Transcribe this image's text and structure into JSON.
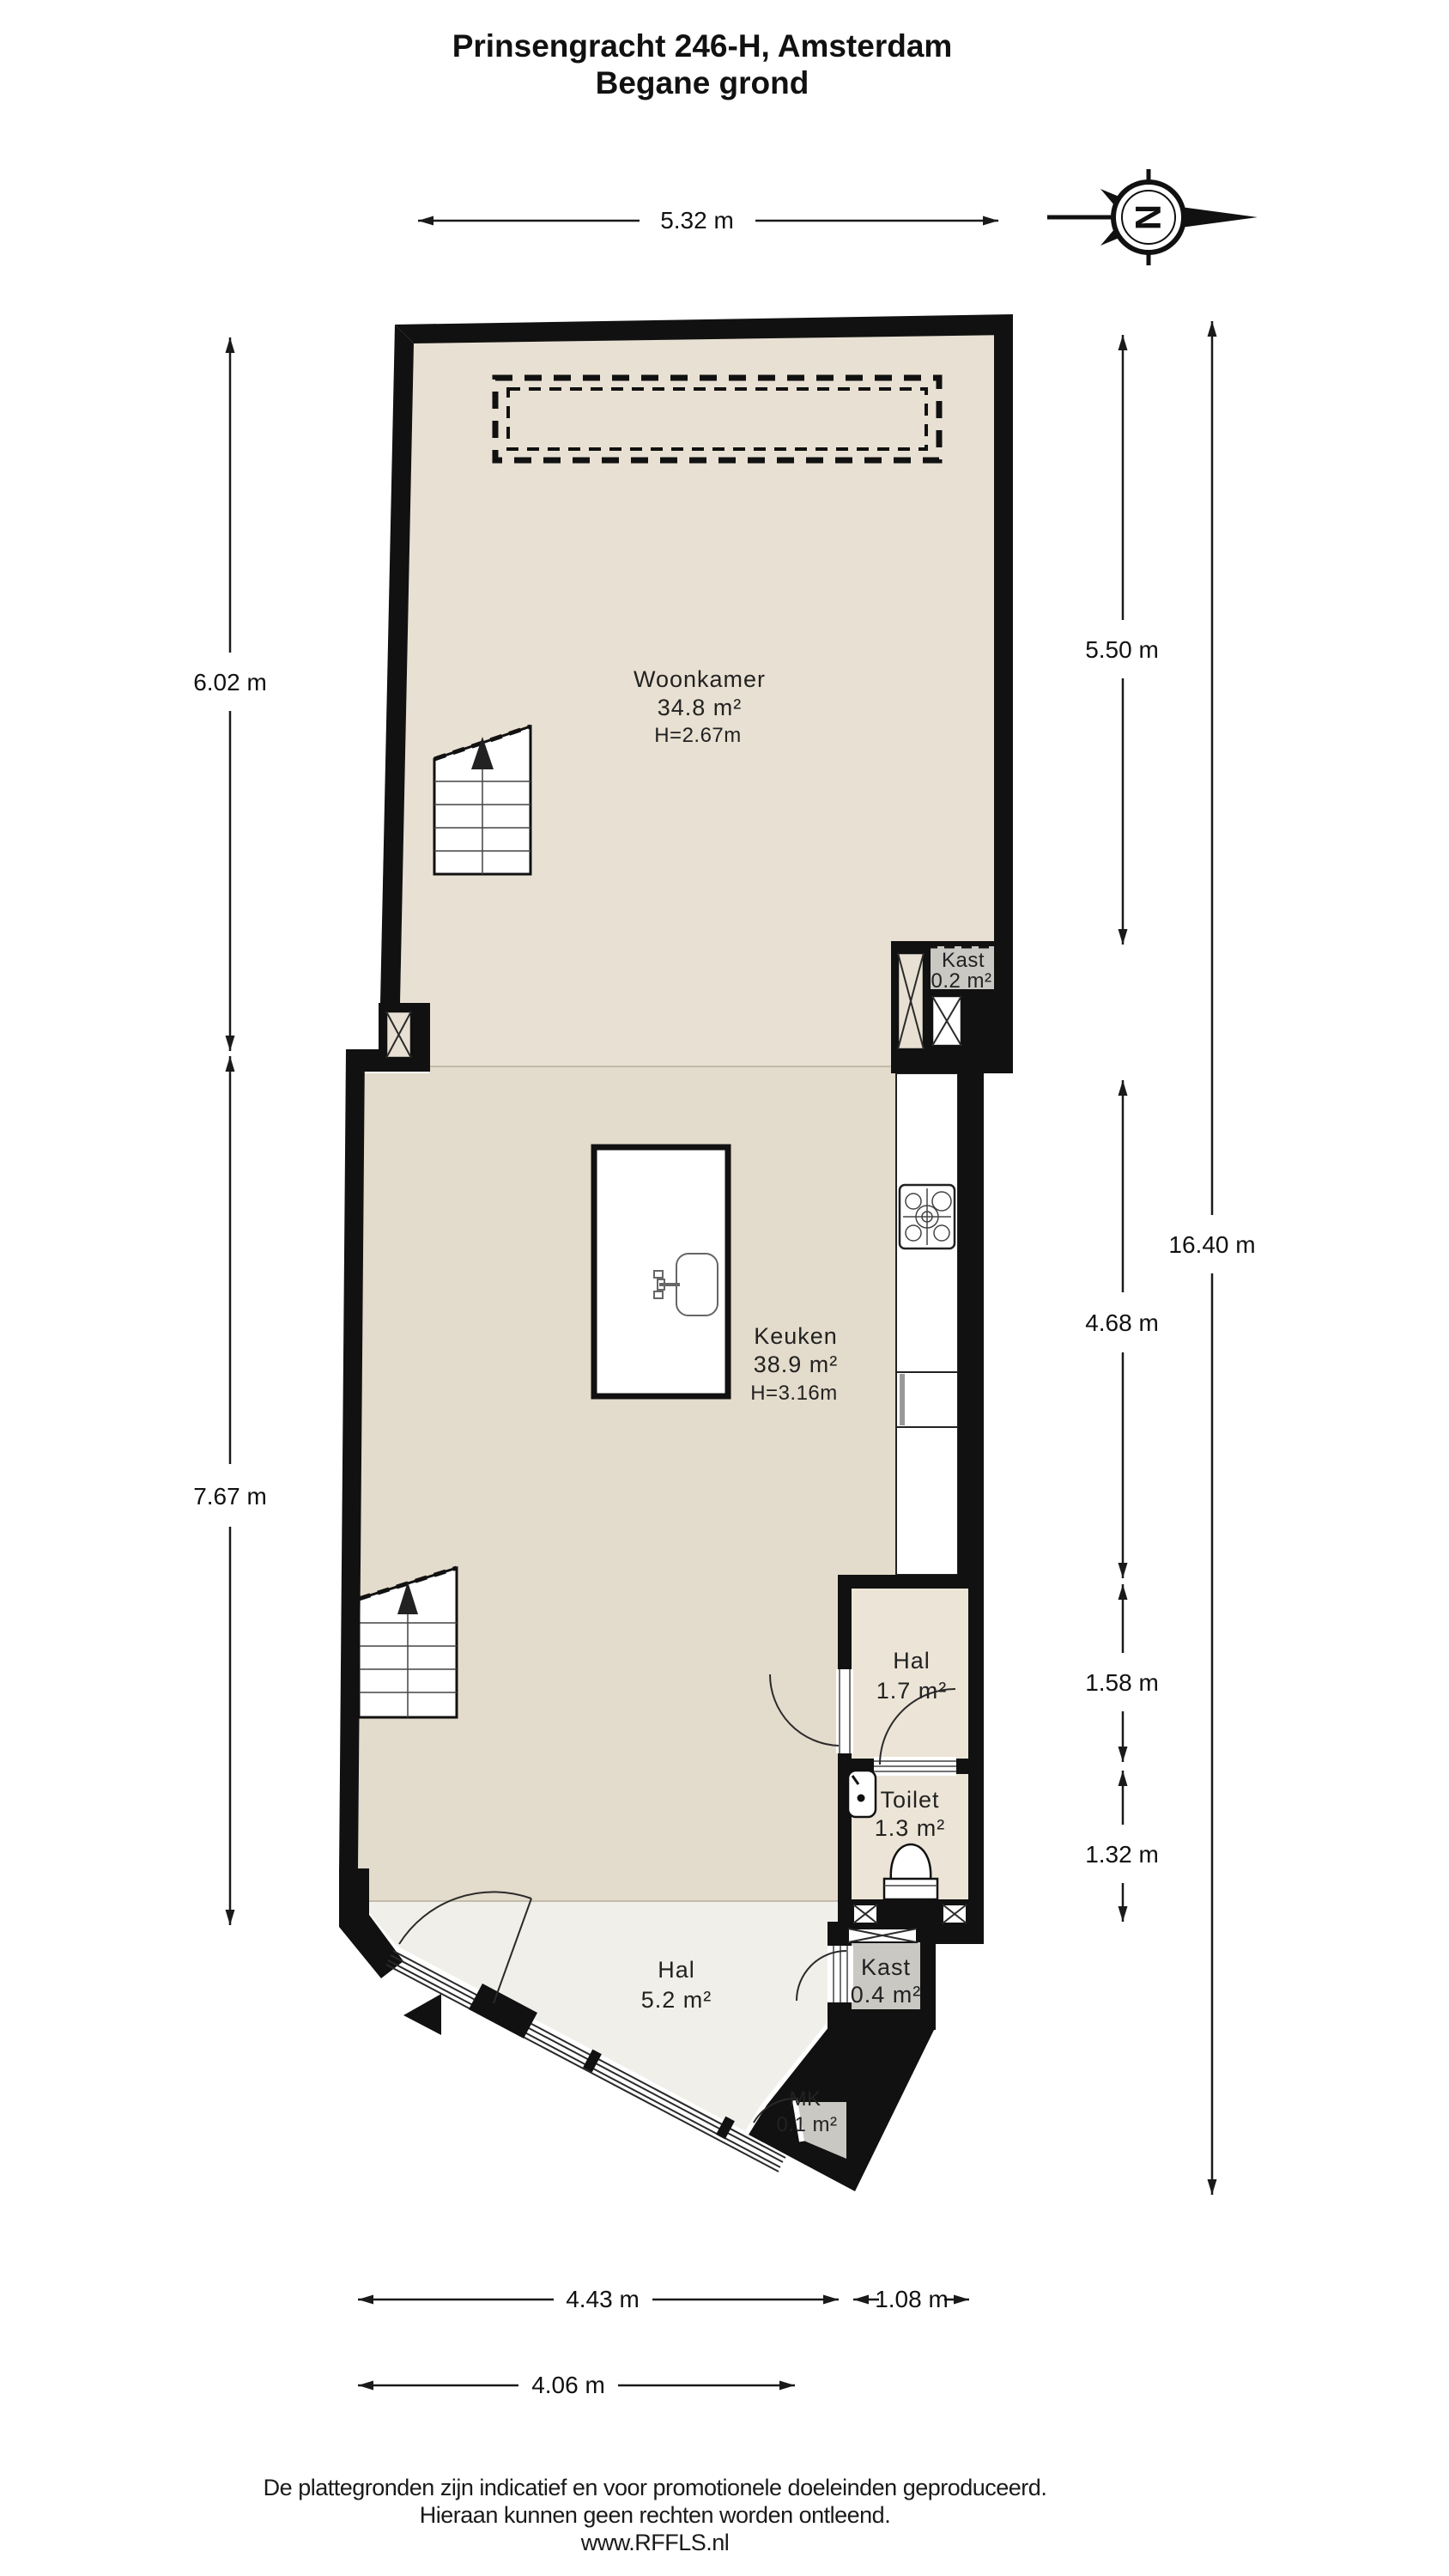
{
  "title": {
    "line1": "Prinsengracht 246-H, Amsterdam",
    "line2": "Begane grond"
  },
  "compass": {
    "letter": "N"
  },
  "rooms": {
    "woonkamer": {
      "name": "Woonkamer",
      "area": "34.8 m²",
      "ceiling": "H=2.67m"
    },
    "keuken": {
      "name": "Keuken",
      "area": "38.9 m²",
      "ceiling": "H=3.16m"
    },
    "hal_binnen": {
      "name": "Hal",
      "area": "1.7 m²"
    },
    "toilet": {
      "name": "Toilet",
      "area": "1.3 m²"
    },
    "kast_boven": {
      "name": "Kast",
      "area": "0.2 m²"
    },
    "kast_onder": {
      "name": "Kast",
      "area": "0.4 m²"
    },
    "hal_entree": {
      "name": "Hal",
      "area": "5.2 m²"
    },
    "meterkast": {
      "name": "MK",
      "area": "0.1 m²"
    }
  },
  "dimensions": {
    "top": "5.32 m",
    "left_upper": "6.02 m",
    "left_lower": "7.67 m",
    "right_upper": "5.50 m",
    "right_kitchen": "4.68 m",
    "right_hal": "1.58 m",
    "right_toilet": "1.32 m",
    "right_total": "16.40 m",
    "bottom_main": "4.43 m",
    "bottom_side": "1.08 m",
    "bottom_inner": "4.06 m"
  },
  "footer": {
    "line1": "De plattegronden zijn indicatief en voor promotionele doeleinden geproduceerd.",
    "line2": "Hieraan kunnen geen rechten worden ontleend.",
    "line3": "www.RFFLS.nl"
  },
  "colors": {
    "wall": "#111111",
    "floor_livingroom": "#e8e0d2",
    "floor_kitchen": "#e3dbcb",
    "floor_hall": "#ece5d7",
    "floor_entry": "#f0efe9",
    "floor_closet": "#c9c8c3"
  }
}
